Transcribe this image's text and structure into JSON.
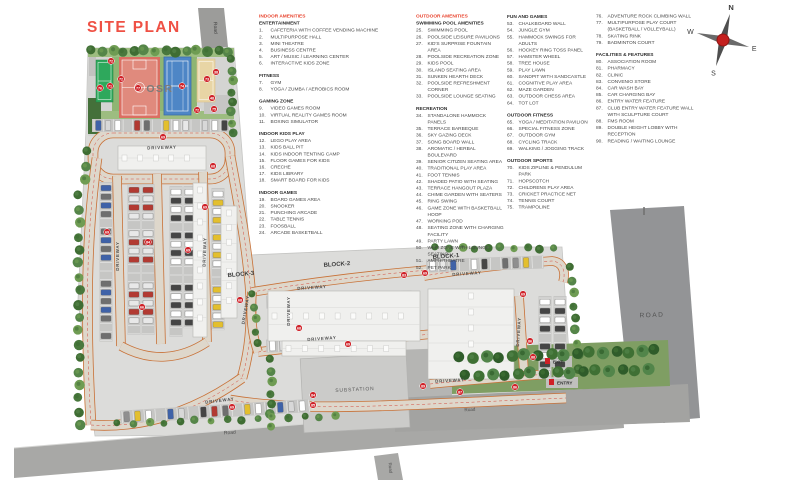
{
  "title": "SITE PLAN",
  "colors": {
    "accent_red": "#e8432d",
    "marker_red": "#cf2027",
    "court_red": "#db6f62",
    "court_blue": "#4e86c6",
    "court_green": "#2ea85c",
    "court_beige": "#e8d5a5",
    "driveway_edge": "#c87137"
  },
  "compass": {
    "north": "N",
    "east": "E",
    "south": "S",
    "west": "W"
  },
  "legend": {
    "columns": [
      {
        "header": "INDOOR AMENITIES",
        "sections": [
          {
            "heading": "ENTERTAINMENT",
            "items": [
              {
                "n": 1,
                "t": "CAFETERIA WITH COFFEE VENDING MACHINE"
              },
              {
                "n": 2,
                "t": "MULTIPURPOSE HALL"
              },
              {
                "n": 3,
                "t": "MINI THEATRE"
              },
              {
                "n": 4,
                "t": "BUSINESS CENTRE"
              },
              {
                "n": 5,
                "t": "ART / MUSIC / LEARNING CENTER"
              },
              {
                "n": 6,
                "t": "INTERACTIVE KIDS ZONE"
              }
            ]
          },
          {
            "heading": "FITNESS",
            "items": [
              {
                "n": 7,
                "t": "GYM"
              },
              {
                "n": 8,
                "t": "YOGA / ZUMBA / AEROBICS ROOM"
              }
            ]
          },
          {
            "heading": "GAMING ZONE",
            "items": [
              {
                "n": 9,
                "t": "VIDEO GAMES ROOM"
              },
              {
                "n": 10,
                "t": "VIRTUAL REALITY GAMES ROOM"
              },
              {
                "n": 11,
                "t": "BOXING SIMULATOR"
              }
            ]
          },
          {
            "heading": "INDOOR KIDS PLAY",
            "items": [
              {
                "n": 12,
                "t": "LEGO PLAY AREA"
              },
              {
                "n": 13,
                "t": "KIDS BALL PIT"
              },
              {
                "n": 14,
                "t": "KIDS INDOOR TENTING CAMP"
              },
              {
                "n": 15,
                "t": "FLOOR GAMES FOR KIDS"
              },
              {
                "n": 16,
                "t": "CRECHE"
              },
              {
                "n": 17,
                "t": "KIDS LIBRARY"
              },
              {
                "n": 18,
                "t": "SMART BOARD FOR KIDS"
              }
            ]
          },
          {
            "heading": "INDOOR GAMES",
            "items": [
              {
                "n": 19,
                "t": "BOARD GAMES AREA"
              },
              {
                "n": 20,
                "t": "SNOOKER"
              },
              {
                "n": 21,
                "t": "PUNCHING ARCADE"
              },
              {
                "n": 22,
                "t": "TABLE TENNIS"
              },
              {
                "n": 23,
                "t": "FOOSBALL"
              },
              {
                "n": 24,
                "t": "ARCADE BASKETBALL"
              }
            ]
          }
        ]
      },
      {
        "header": "OUTDOOR AMENITIES",
        "sections": [
          {
            "heading": "SWIMMING POOL AMENITIES",
            "items": [
              {
                "n": 25,
                "t": "SWIMMING POOL"
              },
              {
                "n": 26,
                "t": "POOLSIDE LEISURE PAVILIONS"
              },
              {
                "n": 27,
                "t": "KID'S SURPRISE FOUNTAIN AREA"
              },
              {
                "n": 28,
                "t": "POOLSIDE RECREATION ZONE"
              },
              {
                "n": 29,
                "t": "KIDS POOL"
              },
              {
                "n": 30,
                "t": "ISLAND SEATING AREA"
              },
              {
                "n": 31,
                "t": "SUNKEN HEARTH DECK"
              },
              {
                "n": 32,
                "t": "POOLSIDE REFRESHMENT CORNER"
              },
              {
                "n": 33,
                "t": "POOLSIDE LOUNGE SEATING"
              }
            ]
          },
          {
            "heading": "RECREATION",
            "items": [
              {
                "n": 34,
                "t": "STANDALONE HAMMOCK PANELS"
              },
              {
                "n": 35,
                "t": "TERRACE BARBEQUE"
              },
              {
                "n": 36,
                "t": "SKY GAZING DECK"
              },
              {
                "n": 37,
                "t": "SONG BOARD WALL"
              },
              {
                "n": 38,
                "t": "AROMATIC / HERBAL BOULEVARD"
              },
              {
                "n": 39,
                "t": "SENIOR CITIZEN SEATING AREA"
              },
              {
                "n": 40,
                "t": "TRADITIONAL PLAY AREA"
              },
              {
                "n": 41,
                "t": "FOOT TENNIS"
              },
              {
                "n": 42,
                "t": "SHADED PATIO WITH SEATING"
              },
              {
                "n": 43,
                "t": "TERRACE HANGOUT PLAZA"
              },
              {
                "n": 44,
                "t": "CHIME GARDEN WITH SEATERS"
              },
              {
                "n": 45,
                "t": "RING SWING"
              },
              {
                "n": 46,
                "t": "GAME ZONE WITH BASKETBALL HOOP"
              },
              {
                "n": 47,
                "t": "WORKING POD"
              },
              {
                "n": 48,
                "t": "SEATING ZONE WITH CHARGING FACILITY"
              },
              {
                "n": 49,
                "t": "PARTY LAWN"
              },
              {
                "n": 50,
                "t": "WI-FI ZONE WITH LOUNGE SEATING"
              },
              {
                "n": 51,
                "t": "AMPHITHEATRE"
              },
              {
                "n": 52,
                "t": "PET PARK"
              }
            ]
          }
        ]
      },
      {
        "header": "",
        "sections": [
          {
            "heading": "FUN AND GAMES",
            "items": [
              {
                "n": 53,
                "t": "CHALKBOARD WALL"
              },
              {
                "n": 54,
                "t": "JUNGLE GYM"
              },
              {
                "n": 55,
                "t": "HAMMOCK SWINGS FOR ADULTS"
              },
              {
                "n": 56,
                "t": "HOCKEY RING TOSS PANEL"
              },
              {
                "n": 57,
                "t": "HAMSTER WHEEL"
              },
              {
                "n": 58,
                "t": "TREE HOUSE"
              },
              {
                "n": 59,
                "t": "PLAY LAWN"
              },
              {
                "n": 60,
                "t": "SANDPIT WITH SANDCASTLE"
              },
              {
                "n": 61,
                "t": "COGNITIVE PLAY AREA"
              },
              {
                "n": 62,
                "t": "MAZE GARDEN"
              },
              {
                "n": 63,
                "t": "OUTDOOR CHESS AREA"
              },
              {
                "n": 64,
                "t": "TOT LOT"
              }
            ]
          },
          {
            "heading": "OUTDOOR FITNESS",
            "items": [
              {
                "n": 65,
                "t": "YOGA / MEDITATION PAVILION"
              },
              {
                "n": 66,
                "t": "SPECIAL FITNESS ZONE"
              },
              {
                "n": 67,
                "t": "OUTDOOR GYM"
              },
              {
                "n": 68,
                "t": "CYCLING TRACK"
              },
              {
                "n": 69,
                "t": "WALKING / JOGGING TRACK"
              }
            ]
          },
          {
            "heading": "OUTDOOR SPORTS",
            "items": [
              {
                "n": 70,
                "t": "KIDS ZIPLINE & PENDULUM PARK"
              },
              {
                "n": 71,
                "t": "HOPSCOTCH"
              },
              {
                "n": 72,
                "t": "CHILDRENS PLAY AREA"
              },
              {
                "n": 73,
                "t": "CRICKET PRACTICE NET"
              },
              {
                "n": 74,
                "t": "TENNIS COURT"
              },
              {
                "n": 75,
                "t": "TRAMPOLINE"
              }
            ]
          }
        ]
      },
      {
        "header": "",
        "sections": [
          {
            "heading": "",
            "items": [
              {
                "n": 76,
                "t": "ADVENTURE ROCK CLIMBING WALL"
              },
              {
                "n": 77,
                "t": "MULTIPURPOSE PLAY COURT (BASKETBALL / VOLLEYBALL)"
              },
              {
                "n": 78,
                "t": "SKATING RINK"
              },
              {
                "n": 79,
                "t": "BADMINTON COURT"
              }
            ]
          },
          {
            "heading": "FACILITIES & FEATURES",
            "items": [
              {
                "n": 80,
                "t": "ASSOCIATION ROOM"
              },
              {
                "n": 81,
                "t": "PHARMACY"
              },
              {
                "n": 82,
                "t": "CLINIC"
              },
              {
                "n": 83,
                "t": "CONVENIO STORE"
              },
              {
                "n": 84,
                "t": "CAR WASH BAY"
              },
              {
                "n": 85,
                "t": "CAR CHARGING BAY"
              },
              {
                "n": 86,
                "t": "ENTRY WATER FEATURE"
              },
              {
                "n": 87,
                "t": "CLUB ENTRY WATER FEATURE WALL WITH SCULPTURE COURT"
              },
              {
                "n": 88,
                "t": "FMS ROOM"
              },
              {
                "n": 89,
                "t": "DOUBLE HEIGHT LOBBY WITH RECEPTION"
              },
              {
                "n": 90,
                "t": "READING / WAITING LOUNGE"
              }
            ]
          }
        ]
      }
    ]
  },
  "plan": {
    "labels": {
      "osr": "OSR",
      "driveway": "DRIVEWAY",
      "road_small": "Road",
      "road_big": "ROAD",
      "substation": "SUBSTATION",
      "entry": "ENTRY",
      "exit": "EXIT",
      "block1": "BLOCK-1",
      "block2": "BLOCK-2",
      "block3": "BLOCK-3"
    },
    "markers": [
      {
        "n": 72,
        "x": 111,
        "y": 61
      },
      {
        "n": 76,
        "x": 100,
        "y": 88
      },
      {
        "n": 71,
        "x": 110,
        "y": 86
      },
      {
        "n": 72,
        "x": 121,
        "y": 79
      },
      {
        "n": 77,
        "x": 138,
        "y": 88
      },
      {
        "n": 74,
        "x": 182,
        "y": 86
      },
      {
        "n": 73,
        "x": 207,
        "y": 79
      },
      {
        "n": 38,
        "x": 216,
        "y": 72
      },
      {
        "n": 48,
        "x": 212,
        "y": 98
      },
      {
        "n": 75,
        "x": 214,
        "y": 109
      },
      {
        "n": 72,
        "x": 197,
        "y": 110
      },
      {
        "n": 69,
        "x": 163,
        "y": 137
      },
      {
        "n": 68,
        "x": 213,
        "y": 166
      },
      {
        "n": 69,
        "x": 107,
        "y": 232
      },
      {
        "n": 84,
        "x": 148,
        "y": 242
      },
      {
        "n": 69,
        "x": 188,
        "y": 250
      },
      {
        "n": 66,
        "x": 142,
        "y": 307
      },
      {
        "n": 69,
        "x": 205,
        "y": 207
      },
      {
        "n": 68,
        "x": 240,
        "y": 300
      },
      {
        "n": 69,
        "x": 232,
        "y": 407
      },
      {
        "n": 68,
        "x": 299,
        "y": 328
      },
      {
        "n": 69,
        "x": 348,
        "y": 344
      },
      {
        "n": 83,
        "x": 404,
        "y": 275
      },
      {
        "n": 69,
        "x": 425,
        "y": 273
      },
      {
        "n": 84,
        "x": 313,
        "y": 395
      },
      {
        "n": 85,
        "x": 313,
        "y": 405
      },
      {
        "n": 69,
        "x": 523,
        "y": 294
      },
      {
        "n": 86,
        "x": 530,
        "y": 341
      },
      {
        "n": 88,
        "x": 533,
        "y": 357
      },
      {
        "n": 87,
        "x": 460,
        "y": 392
      },
      {
        "n": 86,
        "x": 515,
        "y": 387
      },
      {
        "n": 89,
        "x": 423,
        "y": 386
      }
    ]
  }
}
